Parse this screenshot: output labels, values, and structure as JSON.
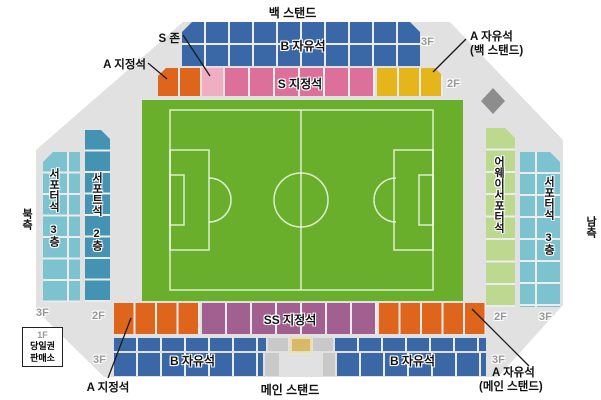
{
  "stands": {
    "back": "백 스탠드",
    "main": "메인 스탠드",
    "north": "북측",
    "south": "남측"
  },
  "seats": {
    "b_free": "B 자유석",
    "s_reserved": "S 지정석",
    "ss_reserved": "SS 지정석",
    "s_zone": "S 존",
    "a_reserved": "A 지정석",
    "a_free": "A 자유석",
    "a_free_back_note": "(백 스탠드)",
    "a_free_main_note": "(메인 스탠드)",
    "supporters_3f": "서포터석 3층",
    "supporters_2f": "서포트석 2층",
    "away_supporters": "어웨이서포터석"
  },
  "floors": {
    "f1": "1F",
    "f2": "2F",
    "f3": "3F"
  },
  "ticket_box": {
    "floor": "1F",
    "line1": "당일권",
    "line2": "판매소"
  },
  "colors": {
    "b_free_blue": "#3a67a6",
    "s_reserved_pink": "#dd6f9b",
    "s_zone_lightpink": "#f0aec3",
    "a_reserved_orange": "#df651c",
    "a_free_yellow": "#e6b51c",
    "ss_reserved_purple": "#a1608f",
    "supporters_2f_teal": "#4493b2",
    "supporters_3f_teal": "#7cc2cf",
    "away_green": "#bcd98f",
    "field_green": "#6aaf2c",
    "stand_gray": "#e1e1e1"
  }
}
